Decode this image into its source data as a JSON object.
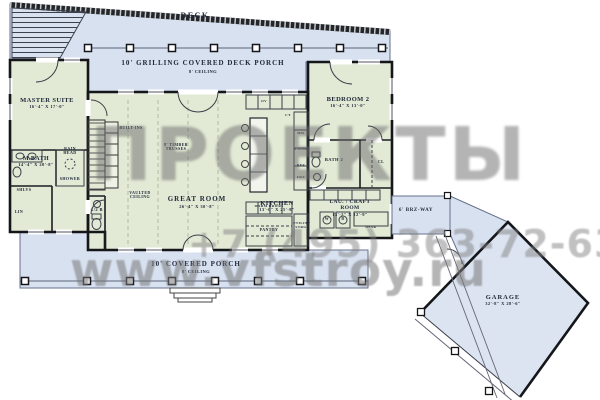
{
  "watermarks": {
    "logo_text": "ПРОЕКТЫ",
    "phone": "+7 (495) 363-72-63",
    "url": "www.vfstroy.ru"
  },
  "colors": {
    "porch_fill": "#d8e1f0",
    "house_fill": "#e2ead6",
    "wall": "#14161a",
    "watermark_gray": "#787878"
  },
  "areas": {
    "deck": {
      "label": "DECK"
    },
    "grilling_porch": {
      "line1": "10' GRILLING COVERED DECK PORCH",
      "line2": "8' CEILING"
    },
    "front_porch": {
      "line1": "10' COVERED PORCH",
      "line2": "8' CEILING"
    },
    "breezeway": {
      "label": "6' BRZ-WAY"
    }
  },
  "rooms": {
    "master_suite": {
      "name": "MASTER SUITE",
      "dims": "16'-4\" X 17'-0\""
    },
    "m_bath": {
      "name": "M.BATH",
      "dims": "14'-4\" X 20'-8\""
    },
    "great_room": {
      "name": "GREAT ROOM",
      "dims": "26'-4\" X 30'-8\""
    },
    "kitchen": {
      "name": "KITCHEN",
      "dims": "13'-0\" X 25'-8\""
    },
    "bedroom2": {
      "name": "BEDROOM 2",
      "dims": "16'-4\" X 13'-0\""
    },
    "laundry": {
      "name": "LAU. / CRAFT ROOM",
      "dims": "13'-2\" X 12'-9\""
    },
    "garage": {
      "name": "GARAGE",
      "dims": "32'-8\" X 28'-6\""
    },
    "half_bath": {
      "name": "1/2 B"
    },
    "bath2": {
      "name": "BATH 2"
    }
  },
  "annotations": {
    "built_ins": "BUILT-INS",
    "timber_trusses": "8' TIMBER TRUSSES",
    "vaulted_ceiling": "VAULTED CEILING",
    "rain_head": "RAIN HEAD",
    "shower": "SHOWER",
    "shelves": "SHLVS",
    "linen": "LIN",
    "warm_drawers": "WARM DRWRS",
    "pantry": "PANTRY",
    "utility_storage": "UTILITY STRG",
    "oven": "OV",
    "cooktop": "CT",
    "microwave": "MW",
    "sink": "D.SINK",
    "fridge": "REF",
    "freezer": "FRZ",
    "washer": "W",
    "dryer": "D",
    "desk": "DESK",
    "closet": "CL"
  }
}
